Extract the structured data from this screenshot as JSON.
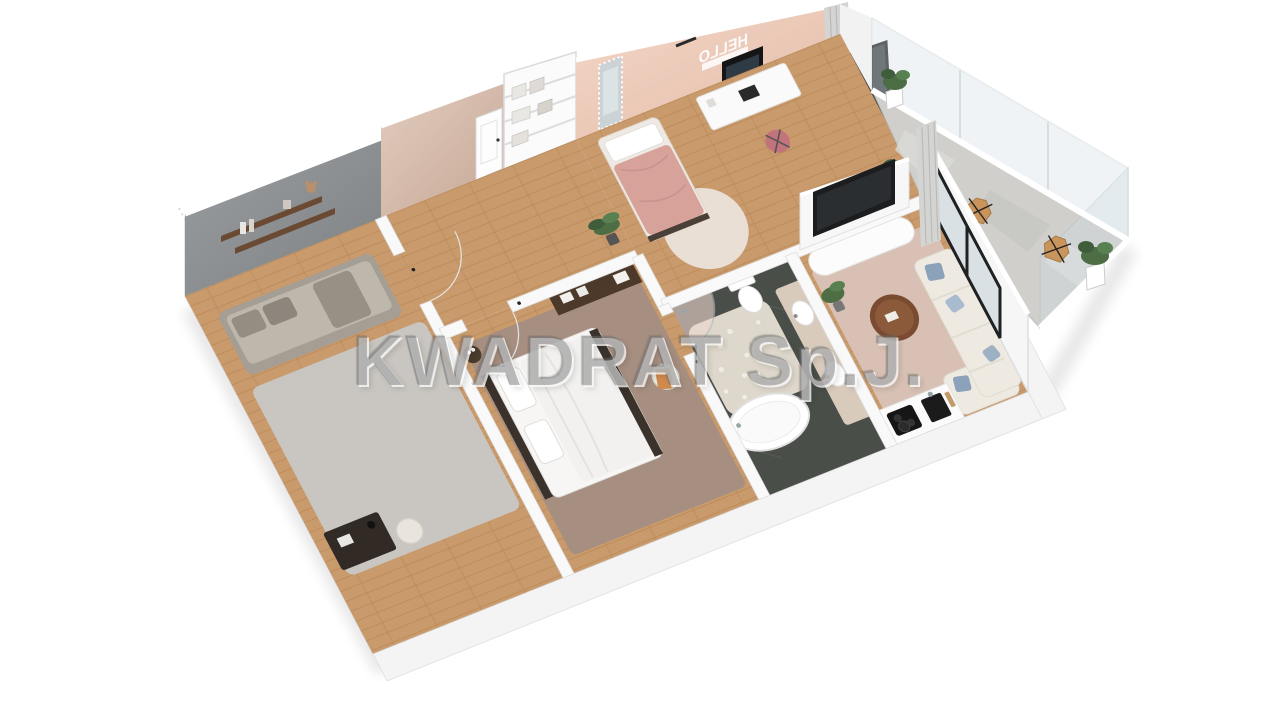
{
  "watermark": {
    "text": "KWADRAT Sp.J.",
    "color": "#707070"
  },
  "decals": {
    "hello": "HELLO"
  },
  "palette": {
    "background": "#ffffff",
    "white_wall": "#f6f6f7",
    "wall_edge": "#dcdddf",
    "gray_wall": "#8d9093",
    "beige_wall": "#cdb3a4",
    "pink_wall": "#eeccbb",
    "wood": "#c99a6c",
    "wood_line": "#b2814e",
    "slate": "#4a4e48",
    "pebble_rug": "#ded7cb",
    "master_rug": "#a68f80",
    "living_rug": "#d8c1b4",
    "gray_rug": "#c9c6c1",
    "pink_rug": "#eadfd4",
    "sofa": "#efeae1",
    "pillow_blue": "#8ca1ba",
    "bed_white": "#f2f1ef",
    "bed_frame": "#3a322b",
    "pink_duvet": "#d7a29a",
    "chair_pink": "#c3737b",
    "orange_throw": "#d08a4e",
    "dark_wood": "#4d392a",
    "table_wood": "#7a4b31",
    "plant_green": "#4d6e45",
    "glass_tint": "#cfdde2",
    "frame_black": "#1c1d1e",
    "balcony_floor": "#d0cfcc",
    "curtain": "#d4d5d2",
    "shelf_wood": "#6b4a33",
    "vanity": "#d9cbbc"
  },
  "rooms": [
    {
      "name": "kids-bedroom",
      "wall_color_key": "gray_wall",
      "furniture": [
        "wall-shelves",
        "teddy-bear",
        "daybed",
        "desk",
        "desk-lamp",
        "desk-chair",
        "rug"
      ]
    },
    {
      "name": "hallway",
      "wall_color_key": "beige_wall",
      "furniture": [
        "storage-shelf",
        "storage-boxes",
        "interior-doors",
        "palm-plant"
      ]
    },
    {
      "name": "master-bedroom",
      "furniture": [
        "double-bed",
        "pillows",
        "side-table",
        "flower-vase",
        "dresser",
        "boxes",
        "armchair",
        "orange-throw",
        "rug"
      ]
    },
    {
      "name": "bathroom",
      "furniture": [
        "freestanding-bathtub",
        "walk-in-shower",
        "toilet",
        "double-vanity",
        "vessel-sinks",
        "pebble-rug"
      ]
    },
    {
      "name": "teen-bedroom",
      "wall_color_key": "pink_wall",
      "decal": "HELLO",
      "furniture": [
        "single-bed",
        "floor-mirror",
        "desk",
        "monitor",
        "desk-chair",
        "round-rug",
        "curtain"
      ]
    },
    {
      "name": "living-room",
      "furniture": [
        "tv",
        "media-console",
        "corner-sofa",
        "blue-pillows",
        "coffee-table",
        "rug",
        "plant"
      ]
    },
    {
      "name": "kitchen",
      "furniture": [
        "counter",
        "cooktop",
        "pot",
        "sink",
        "cutting-boards"
      ]
    },
    {
      "name": "balcony",
      "furniture": [
        "glass-balustrade",
        "butterfly-chair",
        "butterfly-chair",
        "potted-plant",
        "potted-plant",
        "sliding-glass-door",
        "curtain"
      ]
    }
  ]
}
